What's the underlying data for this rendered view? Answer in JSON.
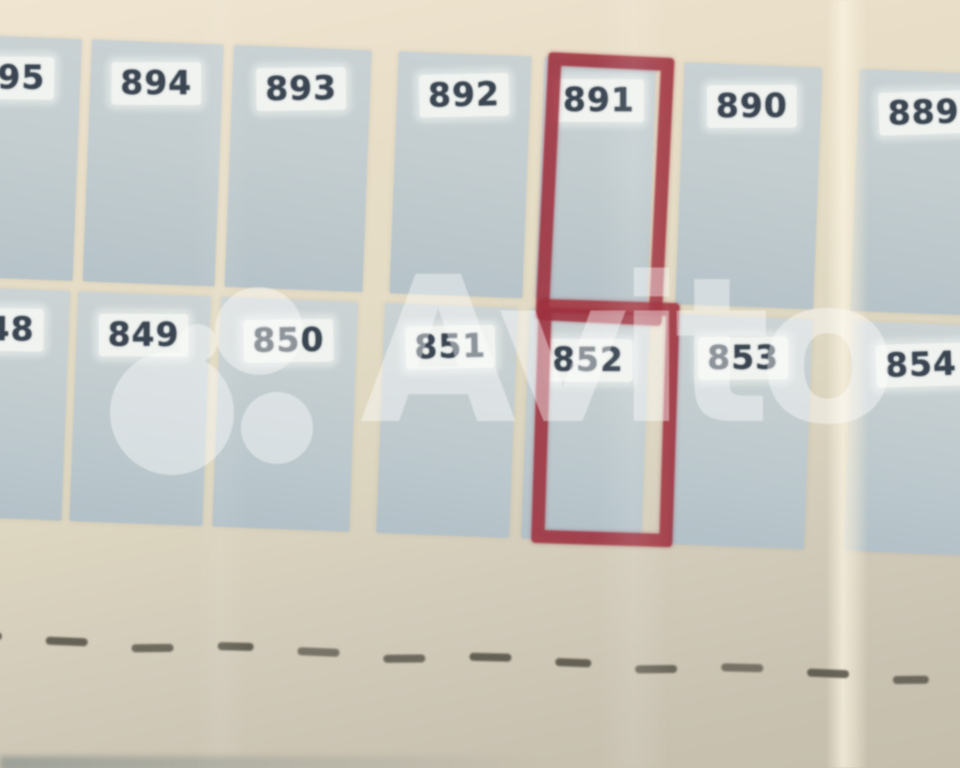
{
  "photo": {
    "description": "Photographed land-plot plan (cadastral scheme) with numbered parcels, two parcels outlined with a red marker, Avito watermark overlay",
    "watermark_brand": "Avito",
    "rows": [
      {
        "name": "top",
        "plots": [
          "895",
          "894",
          "893",
          "892",
          "891",
          "890",
          "889"
        ]
      },
      {
        "name": "bottom",
        "plots": [
          "848",
          "849",
          "850",
          "851",
          "852",
          "853",
          "854"
        ]
      }
    ],
    "highlighted_plots": [
      "891",
      "852"
    ],
    "dash_count": 12,
    "colors": {
      "paper_cream": "#e6dec8",
      "paper_bottom_gray": "#c9c2b1",
      "plot_fill": "#c3cdd0",
      "label_bg": "#f3f5f2",
      "number_ink": "#3b4652",
      "marker_red": "#9e303e",
      "dash_ink": "#524f44",
      "watermark_white": "#ffffff"
    }
  }
}
